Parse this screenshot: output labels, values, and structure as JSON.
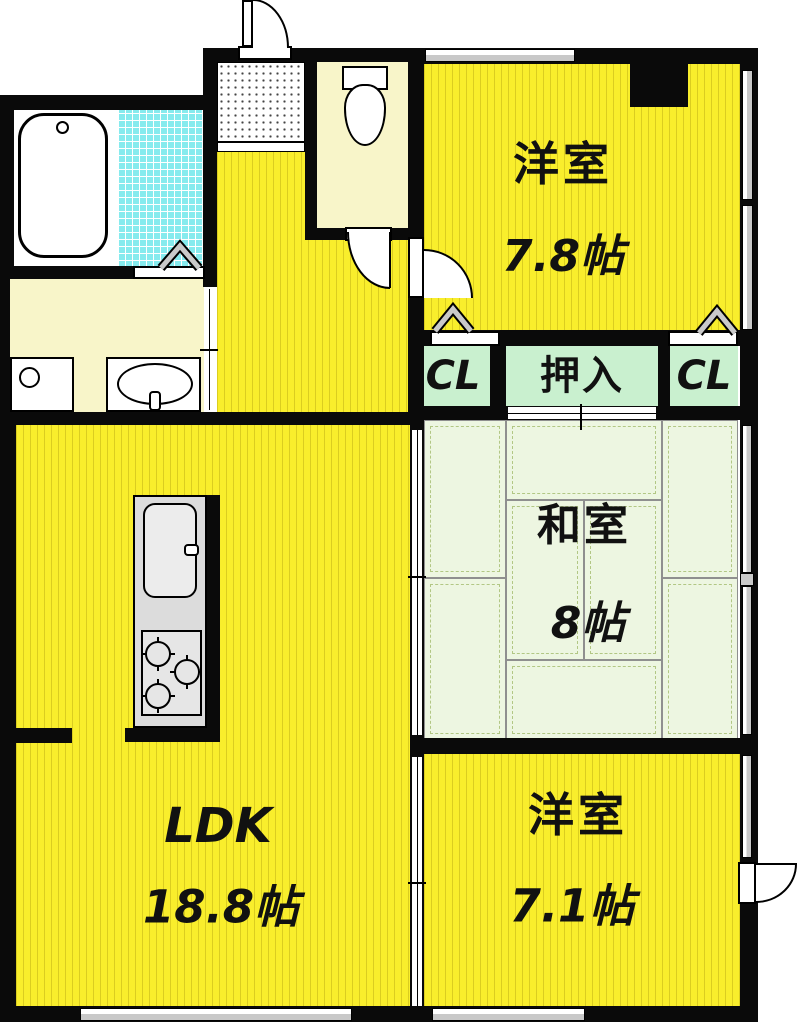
{
  "title": "apartment-floor-plan",
  "palette": {
    "wall": "#0a0a0a",
    "yellow": "#f9ee2c",
    "cream": "#f8f5c9",
    "mint": "#c9f0cf",
    "tatami": "#edf6e1",
    "tile": "#86ebee",
    "gray": "#dcdcdc",
    "wingray": "#c8c8c8"
  },
  "rooms": {
    "western1": {
      "name": "洋室",
      "size": "7.8帖"
    },
    "western2": {
      "name": "洋室",
      "size": "7.1帖"
    },
    "japanese": {
      "name": "和室",
      "size": "8帖"
    },
    "ldk": {
      "name": "LDK",
      "size": "18.8帖"
    }
  },
  "closets": {
    "left_label": "CL",
    "oshiire_label": "押入",
    "right_label": "CL"
  }
}
